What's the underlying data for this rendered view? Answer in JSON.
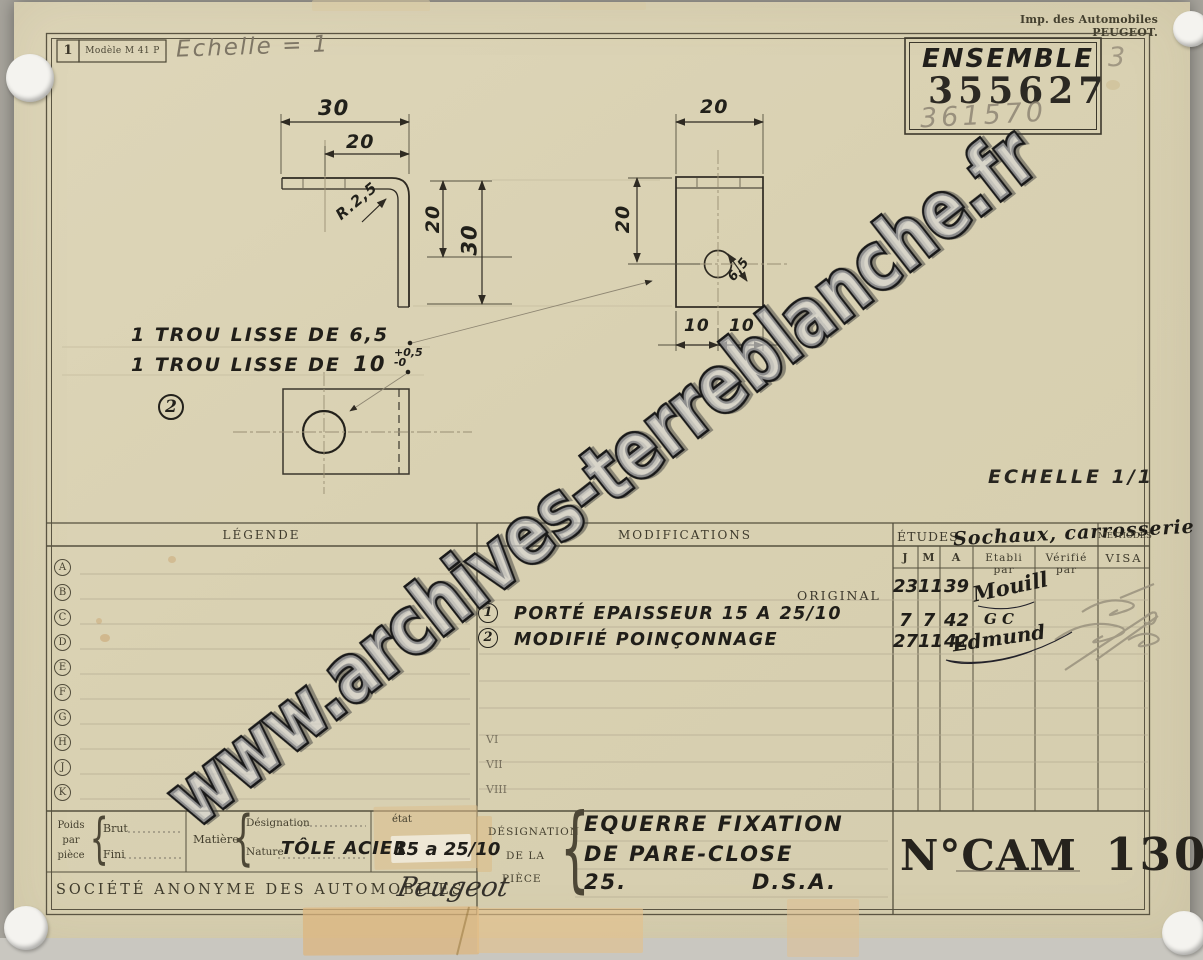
{
  "scan": {
    "watermark": "www.archives-terreblanche.fr",
    "printer_credit": "Imp. des Automobiles PEUGEOT."
  },
  "header": {
    "sheet_number": "1",
    "model_label": "Modèle M 41 P",
    "pencil_note": "Echelle = 1",
    "ensemble_label": "ENSEMBLE",
    "ensemble_number": "355627",
    "ensemble_pencil_number": "361570",
    "ensemble_pencil_mark": "3"
  },
  "drawing": {
    "scale_label": "ECHELLE 1/1",
    "detail_marker": "2",
    "note1": "1 TROU LISSE DE 6,5",
    "note2_text": "1 TROU LISSE DE",
    "note2_value": "10",
    "note2_tol_plus": "+0,5",
    "note2_tol_minus": "-0",
    "dims": {
      "side_width": "30",
      "side_inner_width": "20",
      "bend_radius": "R.2,5",
      "side_height_partial": "20",
      "side_height": "30",
      "front_width": "20",
      "front_height": "20",
      "hole_diameter": "6,5",
      "hole_offset_left": "10",
      "hole_offset_right": "10"
    }
  },
  "legend": {
    "title": "LÉGENDE",
    "rows": [
      "A",
      "B",
      "C",
      "D",
      "E",
      "F",
      "G",
      "H",
      "J",
      "K"
    ]
  },
  "modifications": {
    "title": "MODIFICATIONS",
    "original_label": "ORIGINAL",
    "entries": [
      {
        "marker": "1",
        "text": "PORTÉ EPAISSEUR 15 A 25/10"
      },
      {
        "marker": "2",
        "text": "MODIFIÉ POINÇONNAGE"
      }
    ],
    "roman_rows": [
      "VI",
      "VII",
      "VIII"
    ]
  },
  "etudes": {
    "title": "ÉTUDES",
    "annotation": "Sochaux, carrosserie",
    "methodes_label": "MÉTHODES",
    "columns": {
      "j": "J",
      "m": "M",
      "a": "A",
      "etabli": "Etabli par",
      "verifie": "Vérifié par",
      "visa": "VISA"
    },
    "rows": [
      {
        "j": "23",
        "m": "11",
        "a": "39",
        "signature": "Mouill"
      },
      {
        "j": "7",
        "m": "7",
        "a": "42",
        "signature": "G C"
      },
      {
        "j": "27",
        "m": "11",
        "a": "42",
        "signature": "Edmund"
      }
    ]
  },
  "footer": {
    "brace_glyph": "{",
    "poids_label": "Poids par pièce",
    "brut_label": "Brut",
    "fini_label": "Fini",
    "matiere_label": "Matière",
    "designation_label": "Désignation",
    "nature_label": "Nature",
    "nature_value": "TÔLE ACIER",
    "etat_label": "état",
    "etat_value": "15 a 25/10",
    "company_name": "SOCIÉTÉ ANONYME DES AUTOMOBILES",
    "brand_script": "Peugeot",
    "piece_block_label_1": "DÉSIGNATION",
    "piece_block_label_2": "DE LA",
    "piece_block_label_3": "PIÈCE",
    "piece_line_1": "EQUERRE FIXATION",
    "piece_line_2": "DE PARE-CLOSE",
    "piece_line_3a": "25.",
    "piece_line_3b": "D.S.A.",
    "number_prefix": "N°CAM",
    "number_value": "130"
  }
}
